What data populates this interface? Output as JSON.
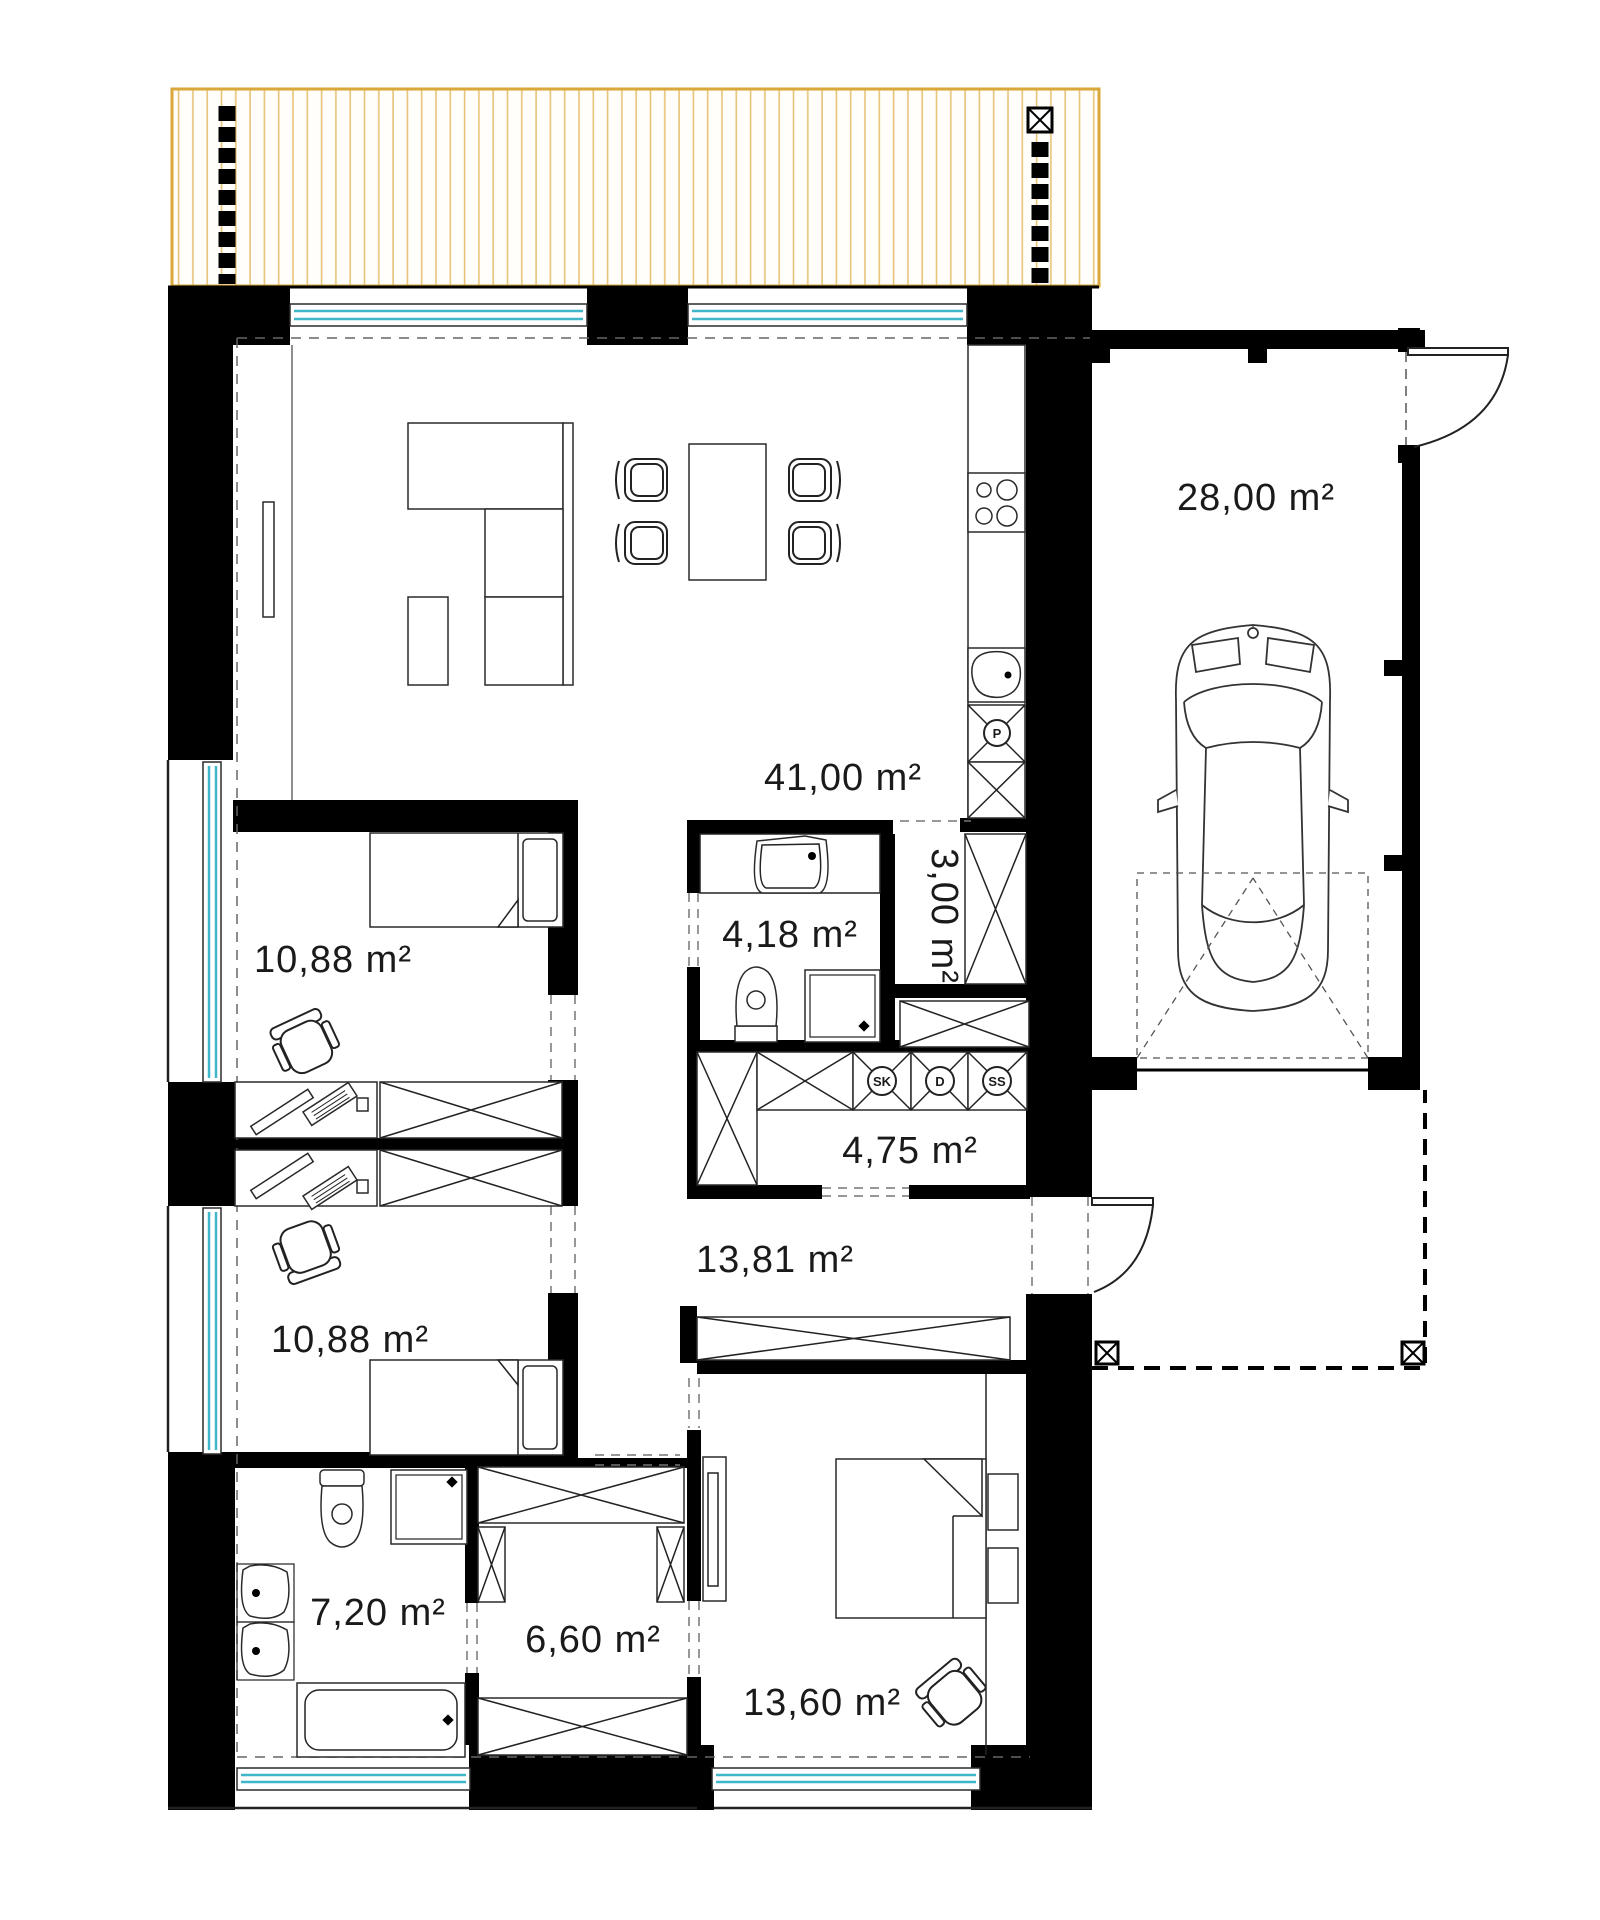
{
  "plan": {
    "name": "house-floor-plan",
    "colors": {
      "wall": "#000000",
      "window_glass": "#3fb6c9",
      "pergola_frame": "#d9a73a",
      "pergola_slats": "#e6c377",
      "dashed_line": "#666666",
      "text": "#1a1a1a"
    },
    "rooms": [
      {
        "id": "living-kitchen",
        "label": "41,00 m²"
      },
      {
        "id": "garage",
        "label": "28,00 m²"
      },
      {
        "id": "bedroom-1",
        "label": "10,88 m²"
      },
      {
        "id": "bathroom-small",
        "label": "4,18 m²"
      },
      {
        "id": "pantry",
        "label": "3,00 m²"
      },
      {
        "id": "corridor",
        "label": "4,75 m²"
      },
      {
        "id": "hall",
        "label": "13,81 m²"
      },
      {
        "id": "bedroom-2",
        "label": "10,88 m²"
      },
      {
        "id": "bathroom-main",
        "label": "7,20 m²"
      },
      {
        "id": "wardrobe",
        "label": "6,60 m²"
      },
      {
        "id": "bedroom-3",
        "label": "13,60 m²"
      }
    ],
    "appliance_tags": [
      {
        "id": "sk",
        "label": "SK"
      },
      {
        "id": "d",
        "label": "D"
      },
      {
        "id": "ss",
        "label": "SS"
      },
      {
        "id": "p",
        "label": "P"
      }
    ]
  }
}
